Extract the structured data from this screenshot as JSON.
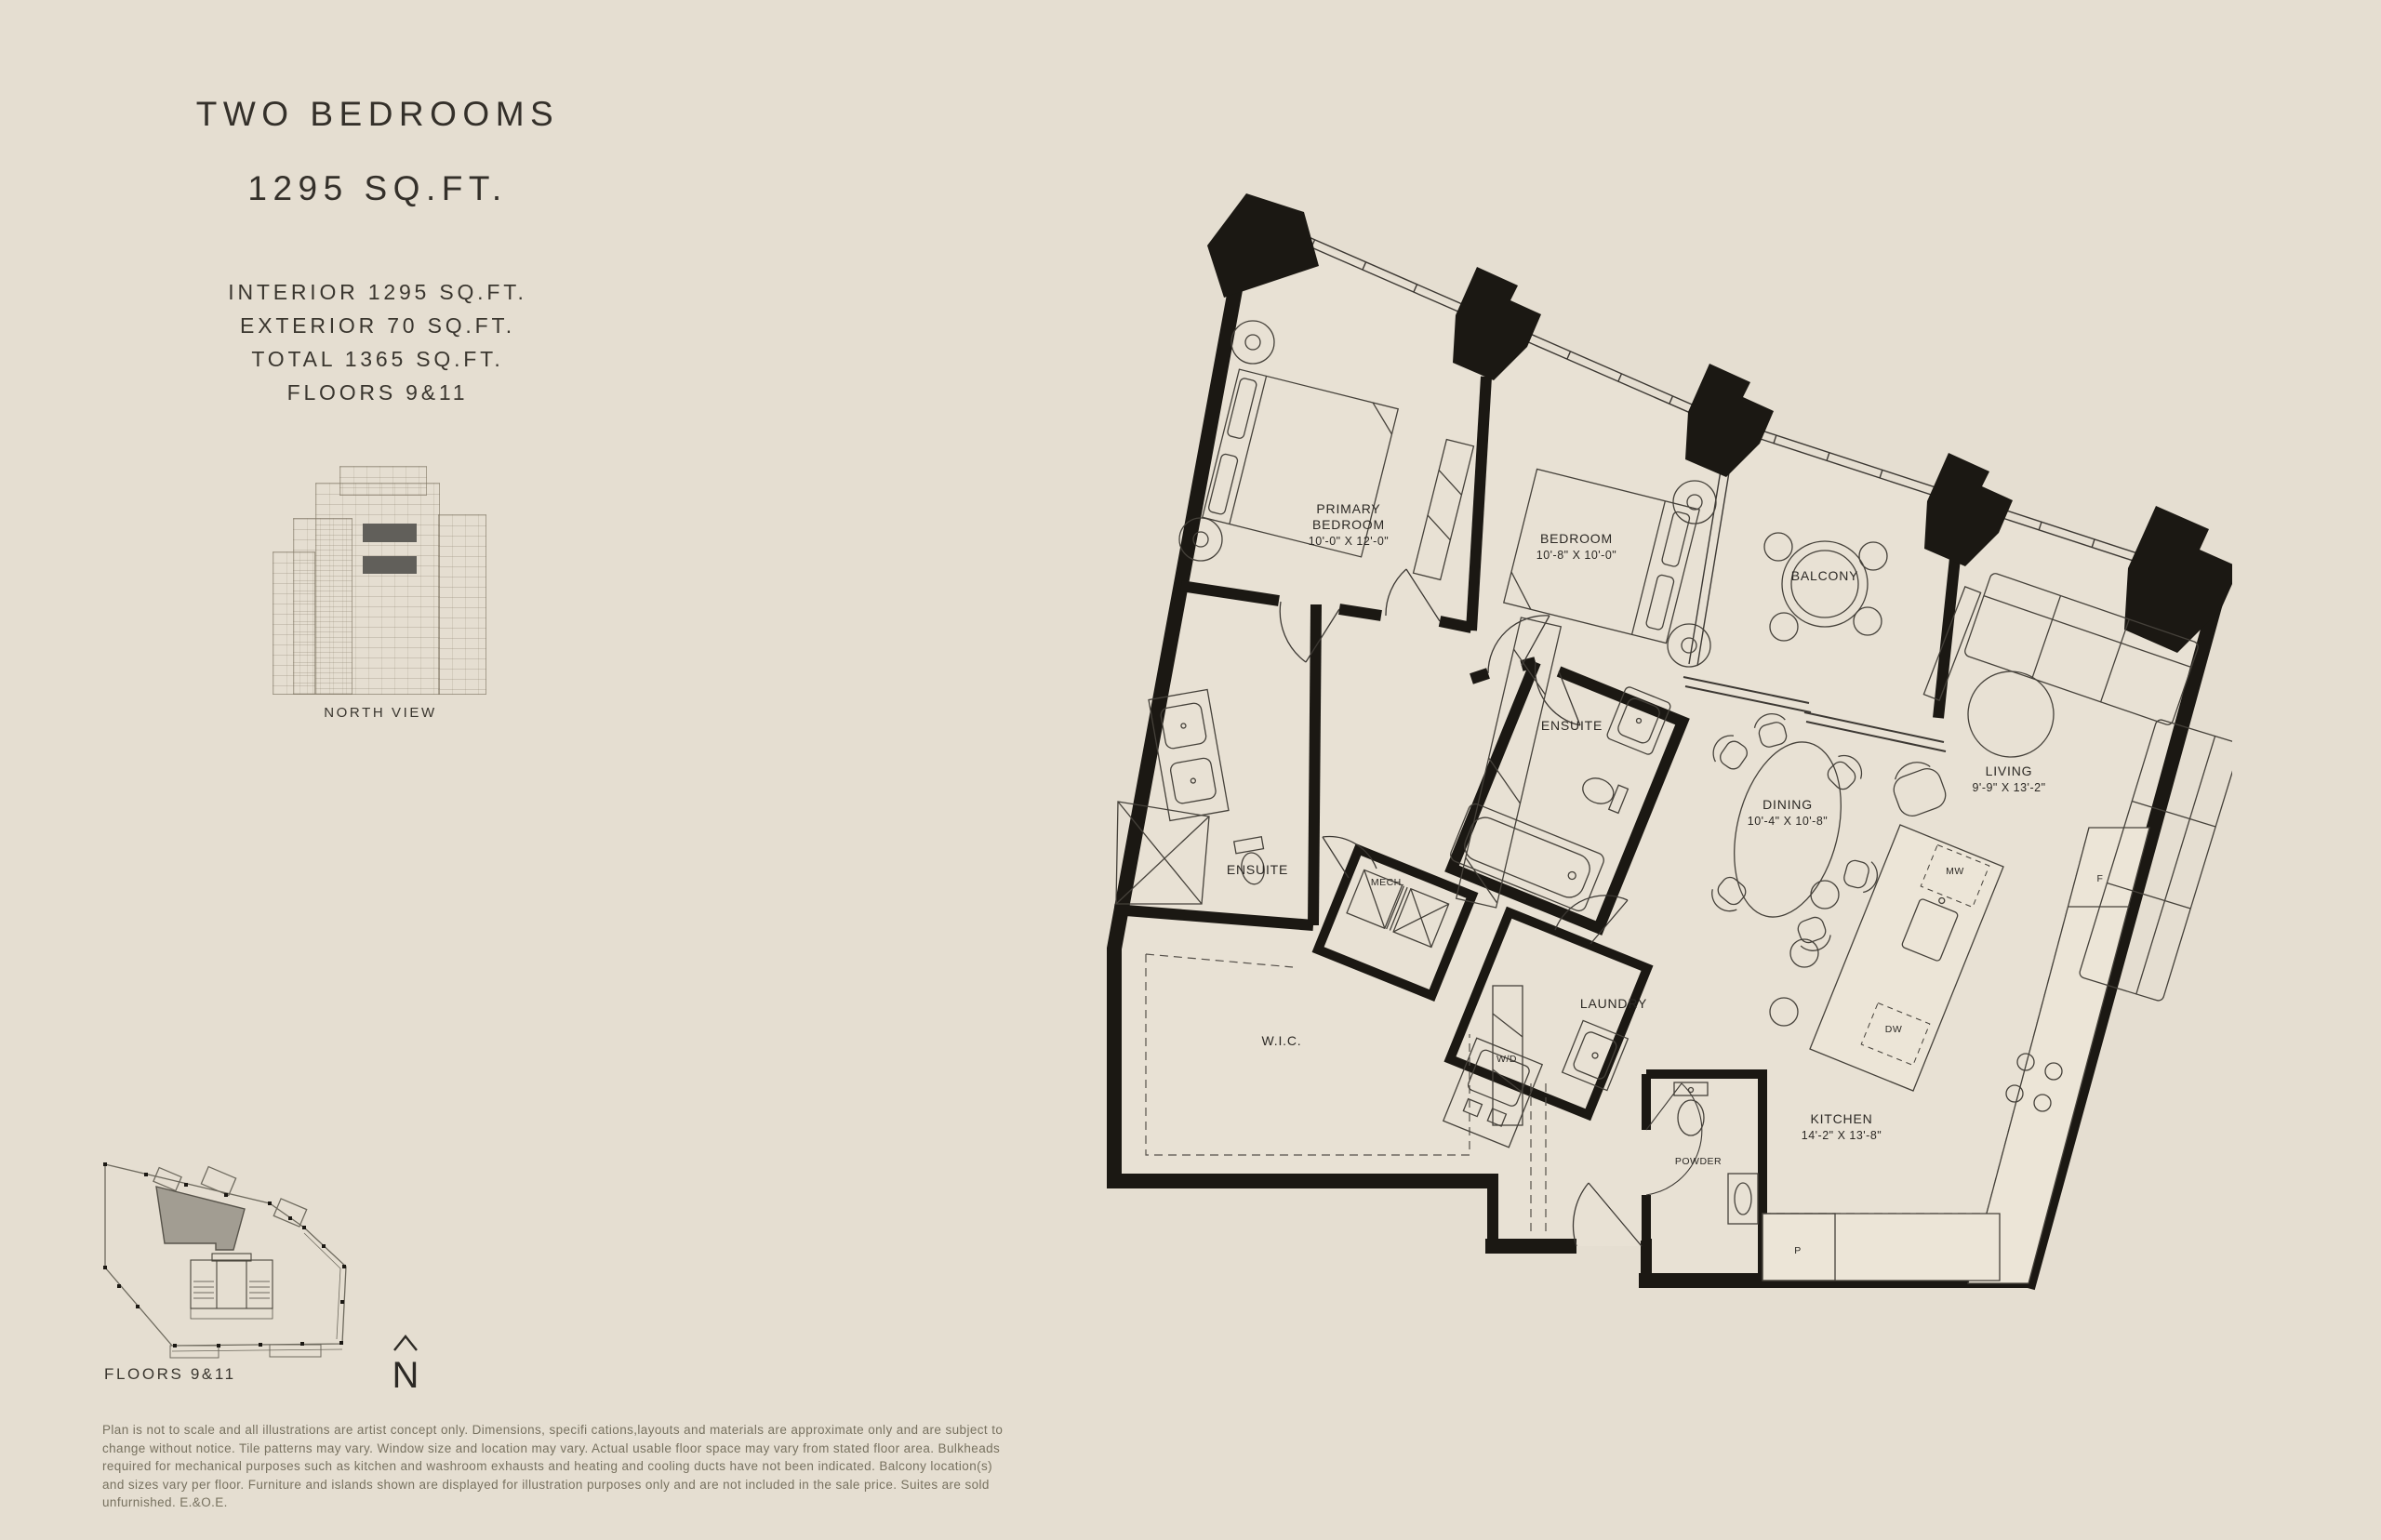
{
  "colors": {
    "background": "#e5ded1",
    "wall_ink": "#1b1813",
    "text_dark": "#34302a",
    "text_muted": "#77715f",
    "keyplan_unit_fill": "#a29d92",
    "elevation_highlight": "#615f5a"
  },
  "sidebar": {
    "title": "TWO BEDROOMS",
    "subtitle": "1295 SQ.FT.",
    "stats": [
      "INTERIOR 1295 SQ.FT.",
      "EXTERIOR 70 SQ.FT.",
      "TOTAL 1365 SQ.FT.",
      "FLOORS 9&11"
    ],
    "elevation_caption": "NORTH VIEW"
  },
  "keyplan": {
    "caption": "FLOORS 9&11",
    "north_label": "N"
  },
  "plan": {
    "rooms": {
      "primary_bedroom": {
        "line1": "PRIMARY",
        "line2": "BEDROOM",
        "dims": "10'-0\" X 12'-0\""
      },
      "bedroom": {
        "name": "BEDROOM",
        "dims": "10'-8\" X 10'-0\""
      },
      "ensuite_primary": {
        "name": "ENSUITE"
      },
      "ensuite_second": {
        "name": "ENSUITE"
      },
      "balcony": {
        "name": "BALCONY"
      },
      "living": {
        "name": "LIVING",
        "dims": "9'-9\" X 13'-2\""
      },
      "dining": {
        "name": "DINING",
        "dims": "10'-4\" X 10'-8\""
      },
      "kitchen": {
        "name": "KITCHEN",
        "dims": "14'-2\" X 13'-8\""
      },
      "wic": {
        "name": "W.I.C."
      },
      "mech": {
        "name": "MECH."
      },
      "laundry": {
        "name": "LAUNDRY"
      },
      "washer_dryer": {
        "name": "W/D"
      },
      "powder": {
        "name": "POWDER"
      }
    },
    "appliances": {
      "microwave": "MW",
      "dishwasher": "DW",
      "fridge": "F",
      "pantry": "P"
    }
  },
  "disclaimer": "Plan is not to scale and all illustrations are artist concept only. Dimensions, specifi cations,layouts and materials are approximate only and are subject to\nchange without notice. Tile patterns may vary. Window size and location may vary. Actual usable floor space may vary from stated floor area. Bulkheads\nrequired for mechanical purposes such as kitchen and washroom exhausts and heating and cooling ducts have not been indicated. Balcony location(s)\nand sizes vary per floor. Furniture and islands shown are displayed for illustration purposes only and are not included in the sale price. Suites are sold\nunfurnished. E.&O.E."
}
